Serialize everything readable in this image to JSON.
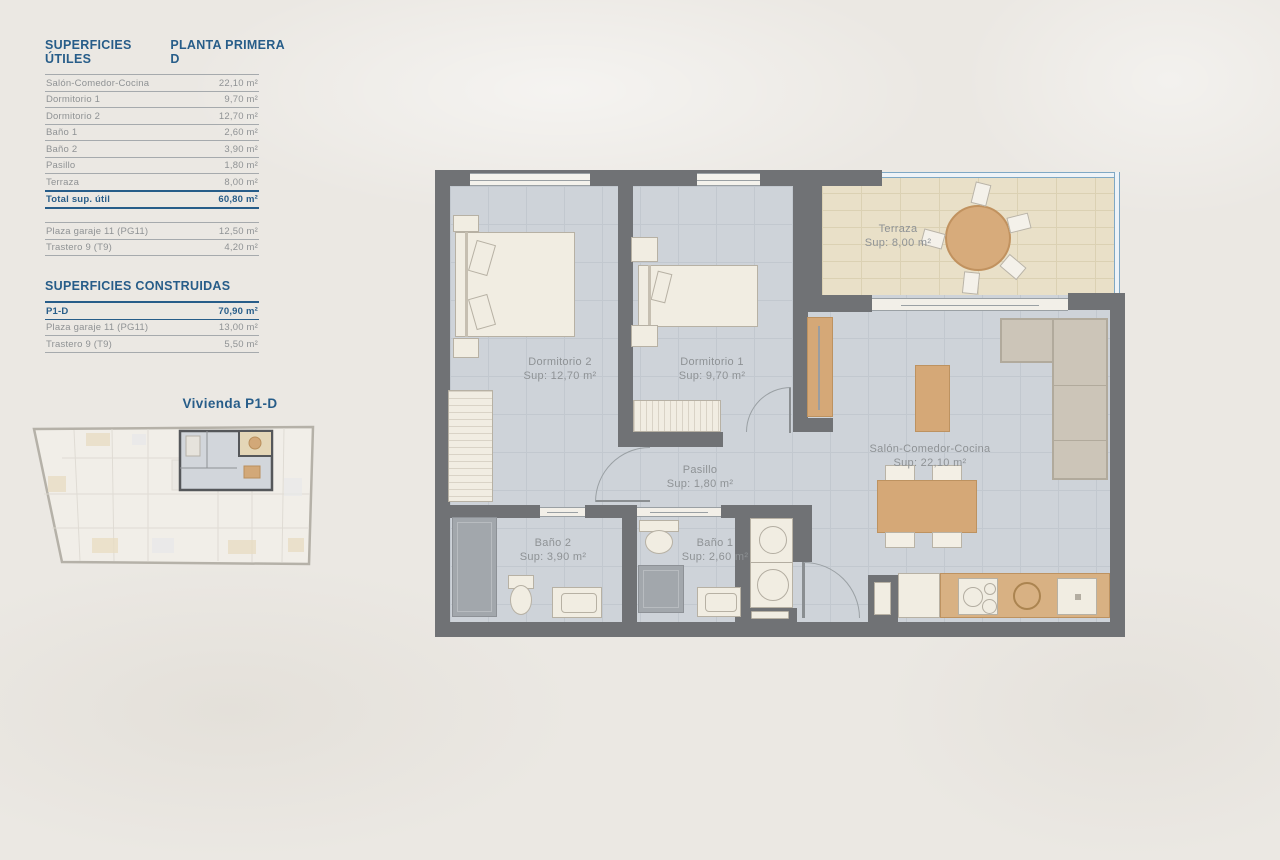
{
  "tables": {
    "utiles": {
      "title": "SUPERFICIES ÚTILES",
      "subtitle": "PLANTA PRIMERA D",
      "rows": [
        {
          "label": "Salón-Comedor-Cocina",
          "value": "22,10 m²"
        },
        {
          "label": "Dormitorio 1",
          "value": "9,70 m²"
        },
        {
          "label": "Dormitorio 2",
          "value": "12,70 m²"
        },
        {
          "label": "Baño 1",
          "value": "2,60 m²"
        },
        {
          "label": "Baño 2",
          "value": "3,90 m²"
        },
        {
          "label": "Pasillo",
          "value": "1,80 m²"
        },
        {
          "label": "Terraza",
          "value": "8,00 m²"
        }
      ],
      "total": {
        "label": "Total sup. útil",
        "value": "60,80 m²"
      },
      "annex_rows": [
        {
          "label": "Plaza garaje 11 (PG11)",
          "value": "12,50 m²"
        },
        {
          "label": "Trastero 9 (T9)",
          "value": "4,20 m²"
        }
      ]
    },
    "construidas": {
      "title": "SUPERFICIES CONSTRUIDAS",
      "rows": [
        {
          "label": "P1-D",
          "value": "70,90 m²"
        },
        {
          "label": "Plaza garaje 11 (PG11)",
          "value": "13,00 m²"
        },
        {
          "label": "Trastero 9 (T9)",
          "value": "5,50 m²"
        }
      ]
    }
  },
  "overview": {
    "title": "Vivienda P1-D"
  },
  "plan": {
    "rooms": [
      {
        "name": "Dormitorio 2",
        "sup": "Sup: 12,70 m²"
      },
      {
        "name": "Dormitorio 1",
        "sup": "Sup: 9,70 m²"
      },
      {
        "name": "Terraza",
        "sup": "Sup: 8,00 m²"
      },
      {
        "name": "Salón-Comedor-Cocina",
        "sup": "Sup: 22,10 m²"
      },
      {
        "name": "Pasillo",
        "sup": "Sup: 1,80 m²"
      },
      {
        "name": "Baño 2",
        "sup": "Sup: 3,90 m²"
      },
      {
        "name": "Baño 1",
        "sup": "Sup: 2,60 m²"
      }
    ]
  },
  "colors": {
    "accent_blue": "#275d89",
    "wall_gray": "#707275",
    "tile_floor": "#ced3d9",
    "terrace_floor": "#e9e0c8",
    "wood": "#d5a877",
    "label_gray": "#8e9295",
    "glass_blue": "#7fa8c4"
  }
}
